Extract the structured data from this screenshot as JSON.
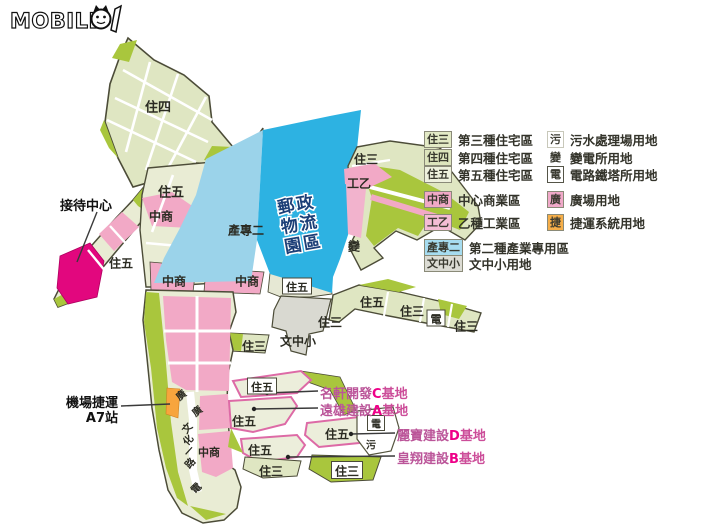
{
  "logo": {
    "word": "MOBILE",
    "digits": "01"
  },
  "map": {
    "park": {
      "lines": [
        "郵政",
        "物流",
        "園區"
      ]
    },
    "labels": [
      {
        "text": "住四",
        "boxed": false
      },
      {
        "text": "住五",
        "boxed": false
      },
      {
        "text": "中商",
        "boxed": false
      },
      {
        "text": "住五",
        "boxed": false
      },
      {
        "text": "中商",
        "boxed": false
      },
      {
        "text": "產專二",
        "boxed": false
      },
      {
        "text": "中商",
        "boxed": false
      },
      {
        "text": "住五",
        "boxed": true
      },
      {
        "text": "住三",
        "boxed": false
      },
      {
        "text": "工乙",
        "boxed": false
      },
      {
        "text": "變",
        "boxed": false
      },
      {
        "text": "住五",
        "boxed": false
      },
      {
        "text": "住三",
        "boxed": false
      },
      {
        "text": "電",
        "boxed": true
      },
      {
        "text": "住三",
        "boxed": false
      },
      {
        "text": "住三",
        "boxed": false
      },
      {
        "text": "文中小",
        "boxed": false
      },
      {
        "text": "住三",
        "boxed": false
      },
      {
        "text": "廣",
        "boxed": false
      },
      {
        "text": "廣",
        "boxed": false
      },
      {
        "text": "文",
        "boxed": false
      },
      {
        "text": "化",
        "boxed": false
      },
      {
        "text": "一",
        "boxed": false
      },
      {
        "text": "路",
        "boxed": false
      },
      {
        "text": "中商",
        "boxed": false
      },
      {
        "text": "電",
        "boxed": false
      },
      {
        "text": "住五",
        "boxed": true
      },
      {
        "text": "住五",
        "boxed": false
      },
      {
        "text": "住五",
        "boxed": false
      },
      {
        "text": "住五",
        "boxed": false
      },
      {
        "text": "電",
        "boxed": true
      },
      {
        "text": "污",
        "boxed": false
      },
      {
        "text": "住三",
        "boxed": false
      },
      {
        "text": "住三",
        "boxed": true
      }
    ],
    "callouts": {
      "reception": "接待中心",
      "station_line1": "機場捷運",
      "station_line2": "A7站"
    },
    "sites": [
      {
        "name": "名軒開發",
        "letter": "C",
        "suffix": "基地"
      },
      {
        "name": "遠雄建設",
        "letter": "A",
        "suffix": "基地"
      },
      {
        "name": "麗寶建設",
        "letter": "D",
        "suffix": "基地"
      },
      {
        "name": "皇翔建設",
        "letter": "B",
        "suffix": "基地"
      }
    ]
  },
  "legend": {
    "left": [
      {
        "key": "住三",
        "label": "第三種住宅區",
        "swatch": "#e3eac6",
        "style": "fill"
      },
      {
        "key": "住四",
        "label": "第四種住宅區",
        "swatch": "#dde5bd",
        "style": "fill"
      },
      {
        "key": "住五",
        "label": "第五種住宅區",
        "swatch": "#eef1dd",
        "style": "fill"
      },
      {
        "key": "中商",
        "label": "中心商業區",
        "swatch": "#f1a9c7",
        "style": "fill"
      },
      {
        "key": "工乙",
        "label": "乙種工業區",
        "swatch": "#f5bcd4",
        "style": "fill"
      },
      {
        "key": "產專二",
        "label": "第二種產業專用區",
        "swatch": "#a6dcf0",
        "style": "fill"
      },
      {
        "key": "文中小",
        "label": "文中小用地",
        "swatch": "#dcdcd4",
        "style": "fill"
      }
    ],
    "right": [
      {
        "key": "污",
        "label": "污水處理場用地",
        "swatch": "#ffffff",
        "style": "white"
      },
      {
        "key": "變",
        "label": "變電所用地",
        "swatch": "",
        "style": "plain"
      },
      {
        "key": "電",
        "label": "電路鐵塔所用地",
        "swatch": "#ffffff",
        "style": "boxed"
      },
      {
        "key": "廣",
        "label": "廣場用地",
        "swatch": "#f0a9c9",
        "style": "fill"
      },
      {
        "key": "捷",
        "label": "捷運系統用地",
        "swatch": "#f6ae49",
        "style": "fill"
      }
    ]
  },
  "colors": {
    "cyan": "#2db2e2",
    "light_blue": "#9bd3ea",
    "pink": "#f2a9c6",
    "magenta": "#e2077e",
    "olive": "#a9c63d",
    "pale": "#e9ecd4",
    "pale_green": "#dfe6c2",
    "gray": "#d9d9d1",
    "orange": "#f7a53d",
    "park_text": "#1c3f77",
    "outline": "#4c4c38"
  }
}
